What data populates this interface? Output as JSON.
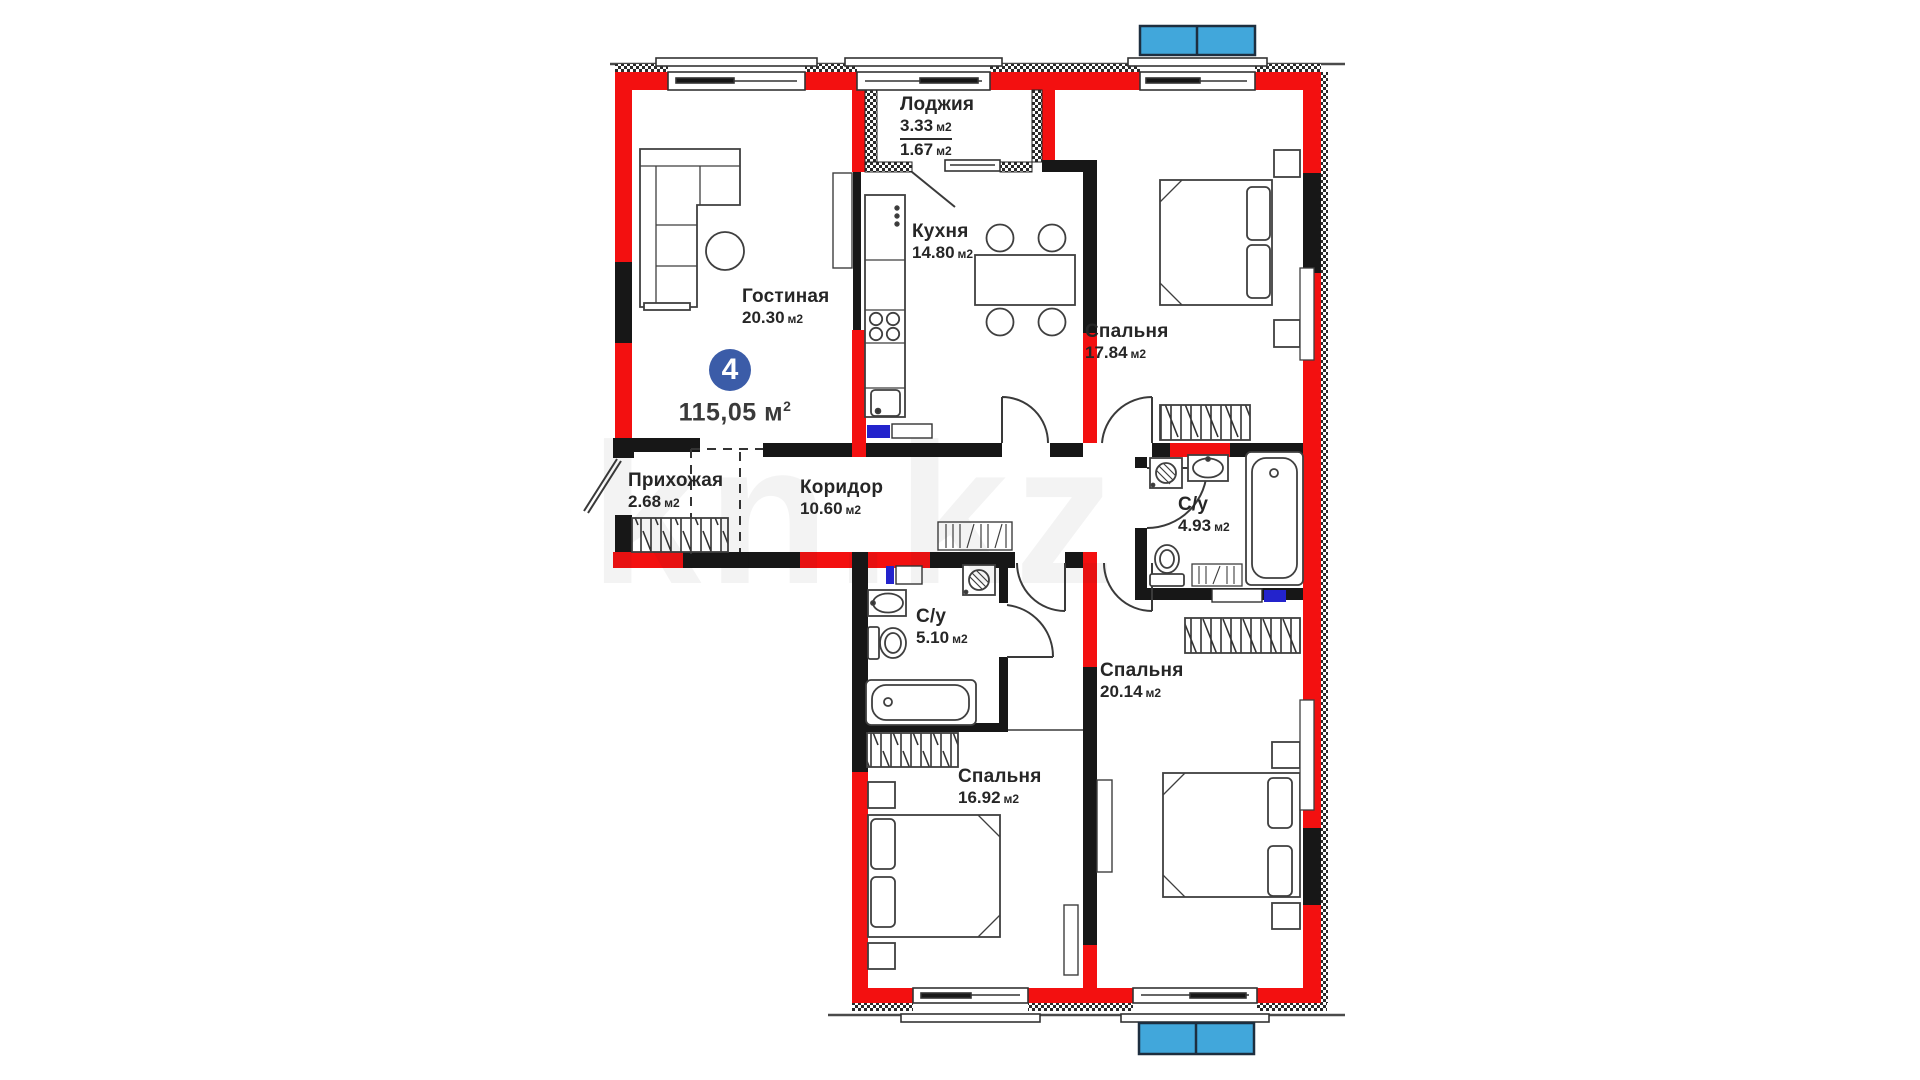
{
  "page": {
    "background": "#ffffff"
  },
  "badge": {
    "number": "4",
    "area": "115,05 м",
    "area_sup": "2"
  },
  "watermark": {
    "text": "kn.kz"
  },
  "colors": {
    "wall_red": "#f31010",
    "wall_black": "#171717",
    "marker_blue": "#41a7db",
    "badge_blue": "#3b5ca8",
    "pipe_blue": "#2323cc",
    "line_gray": "#3f3f3f"
  },
  "rooms": [
    {
      "name": "Лоджия",
      "area": "3.33",
      "unit": "м2",
      "area2": "1.67",
      "unit2": "м2"
    },
    {
      "name": "Кухня",
      "area": "14.80",
      "unit": "м2"
    },
    {
      "name": "Гостиная",
      "area": "20.30",
      "unit": "м2"
    },
    {
      "name": "Спальня",
      "area": "17.84",
      "unit": "м2"
    },
    {
      "name": "Прихожая",
      "area": "2.68",
      "unit": "м2"
    },
    {
      "name": "Коридор",
      "area": "10.60",
      "unit": "м2"
    },
    {
      "name": "С/у",
      "area": "4.93",
      "unit": "м2"
    },
    {
      "name": "С/у",
      "area": "5.10",
      "unit": "м2"
    },
    {
      "name": "Спальня",
      "area": "20.14",
      "unit": "м2"
    },
    {
      "name": "Спальня",
      "area": "16.92",
      "unit": "м2"
    }
  ]
}
